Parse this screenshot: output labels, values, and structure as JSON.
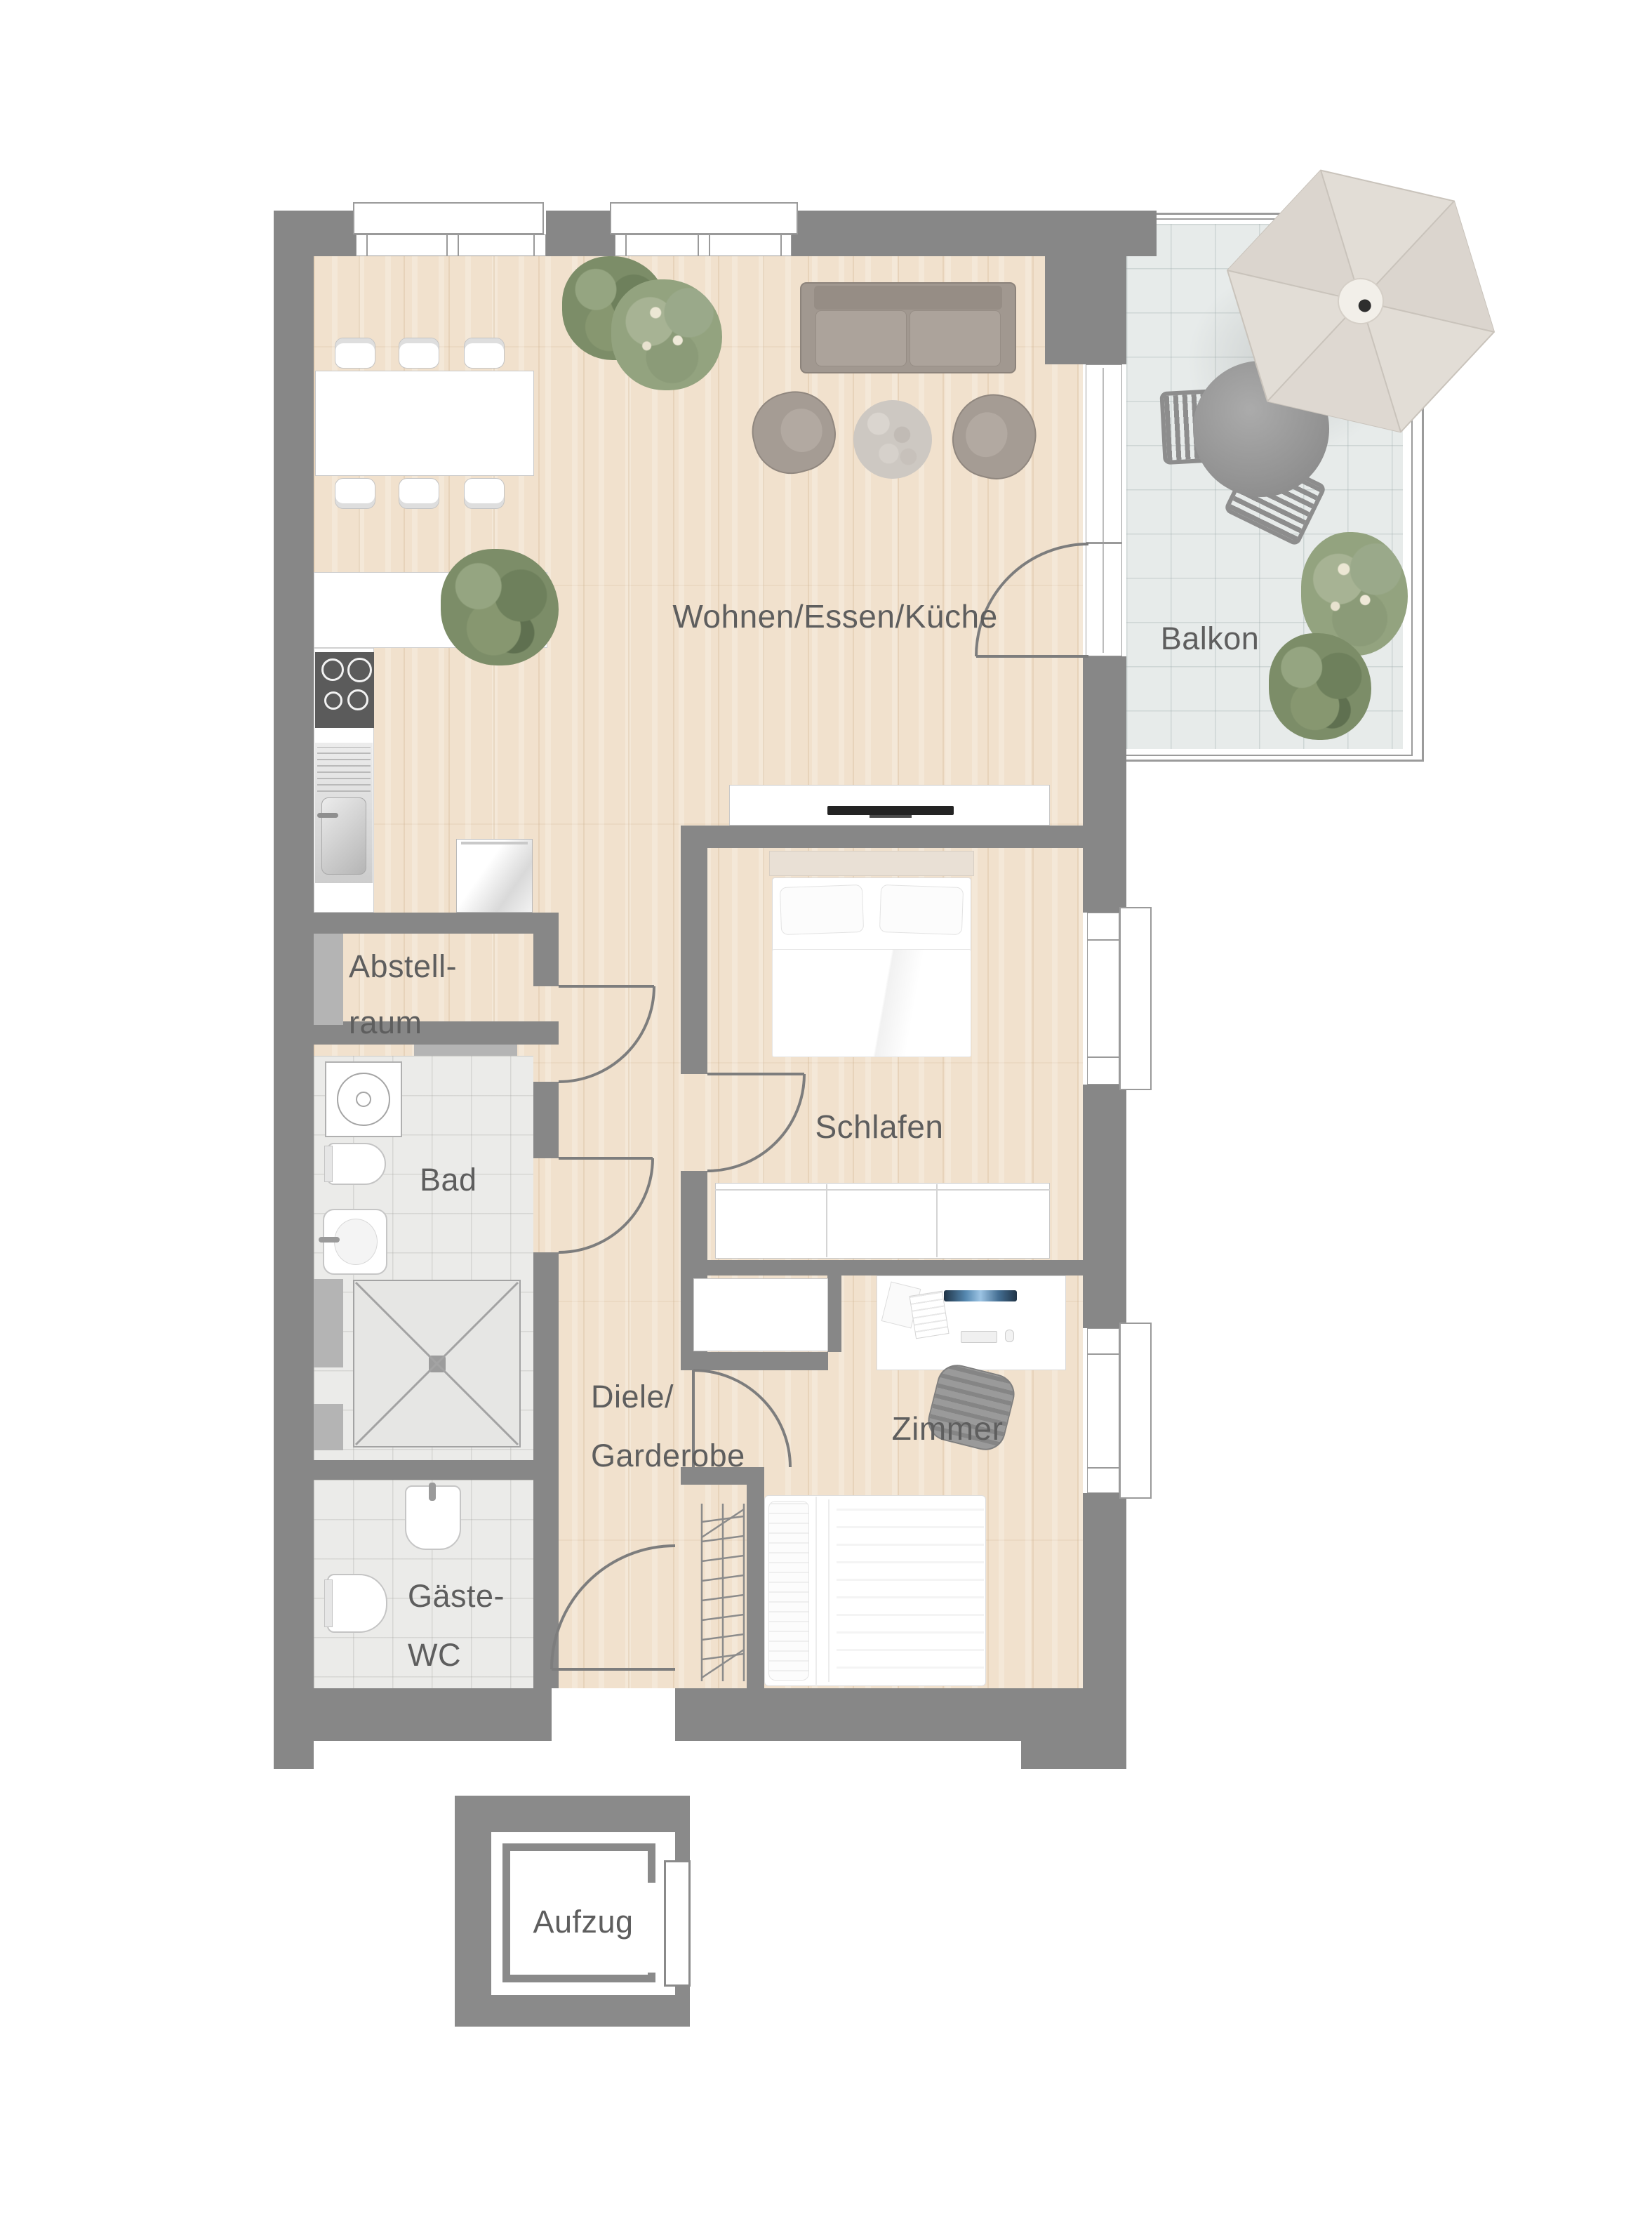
{
  "meta": {
    "type": "apartment-floor-plan",
    "language": "de",
    "view": "top-down"
  },
  "colors": {
    "wall": "#878787",
    "wall_light": "#b4b4b4",
    "line": "#9a9a9a",
    "door": "#7d7d7d",
    "floor_wood": "#f1e1cd",
    "tile_bath": "#ebebe9",
    "tile_balcony": "#e7ebea",
    "text": "#5e5e5e",
    "furn": "#a19890",
    "umbrella": "#e2ddd6"
  },
  "rooms": {
    "living": {
      "label": "Wohnen/Essen/Küche"
    },
    "balcony": {
      "label": "Balkon"
    },
    "storage": {
      "label_line1": "Abstell-",
      "label_line2": "raum"
    },
    "bath": {
      "label": "Bad"
    },
    "hall": {
      "label_line1": "Diele/",
      "label_line2": "Garderobe"
    },
    "guest_wc": {
      "label_line1": "Gäste-",
      "label_line2": "WC"
    },
    "bedroom": {
      "label": "Schlafen"
    },
    "room": {
      "label": "Zimmer"
    },
    "elevator": {
      "label": "Aufzug"
    }
  }
}
